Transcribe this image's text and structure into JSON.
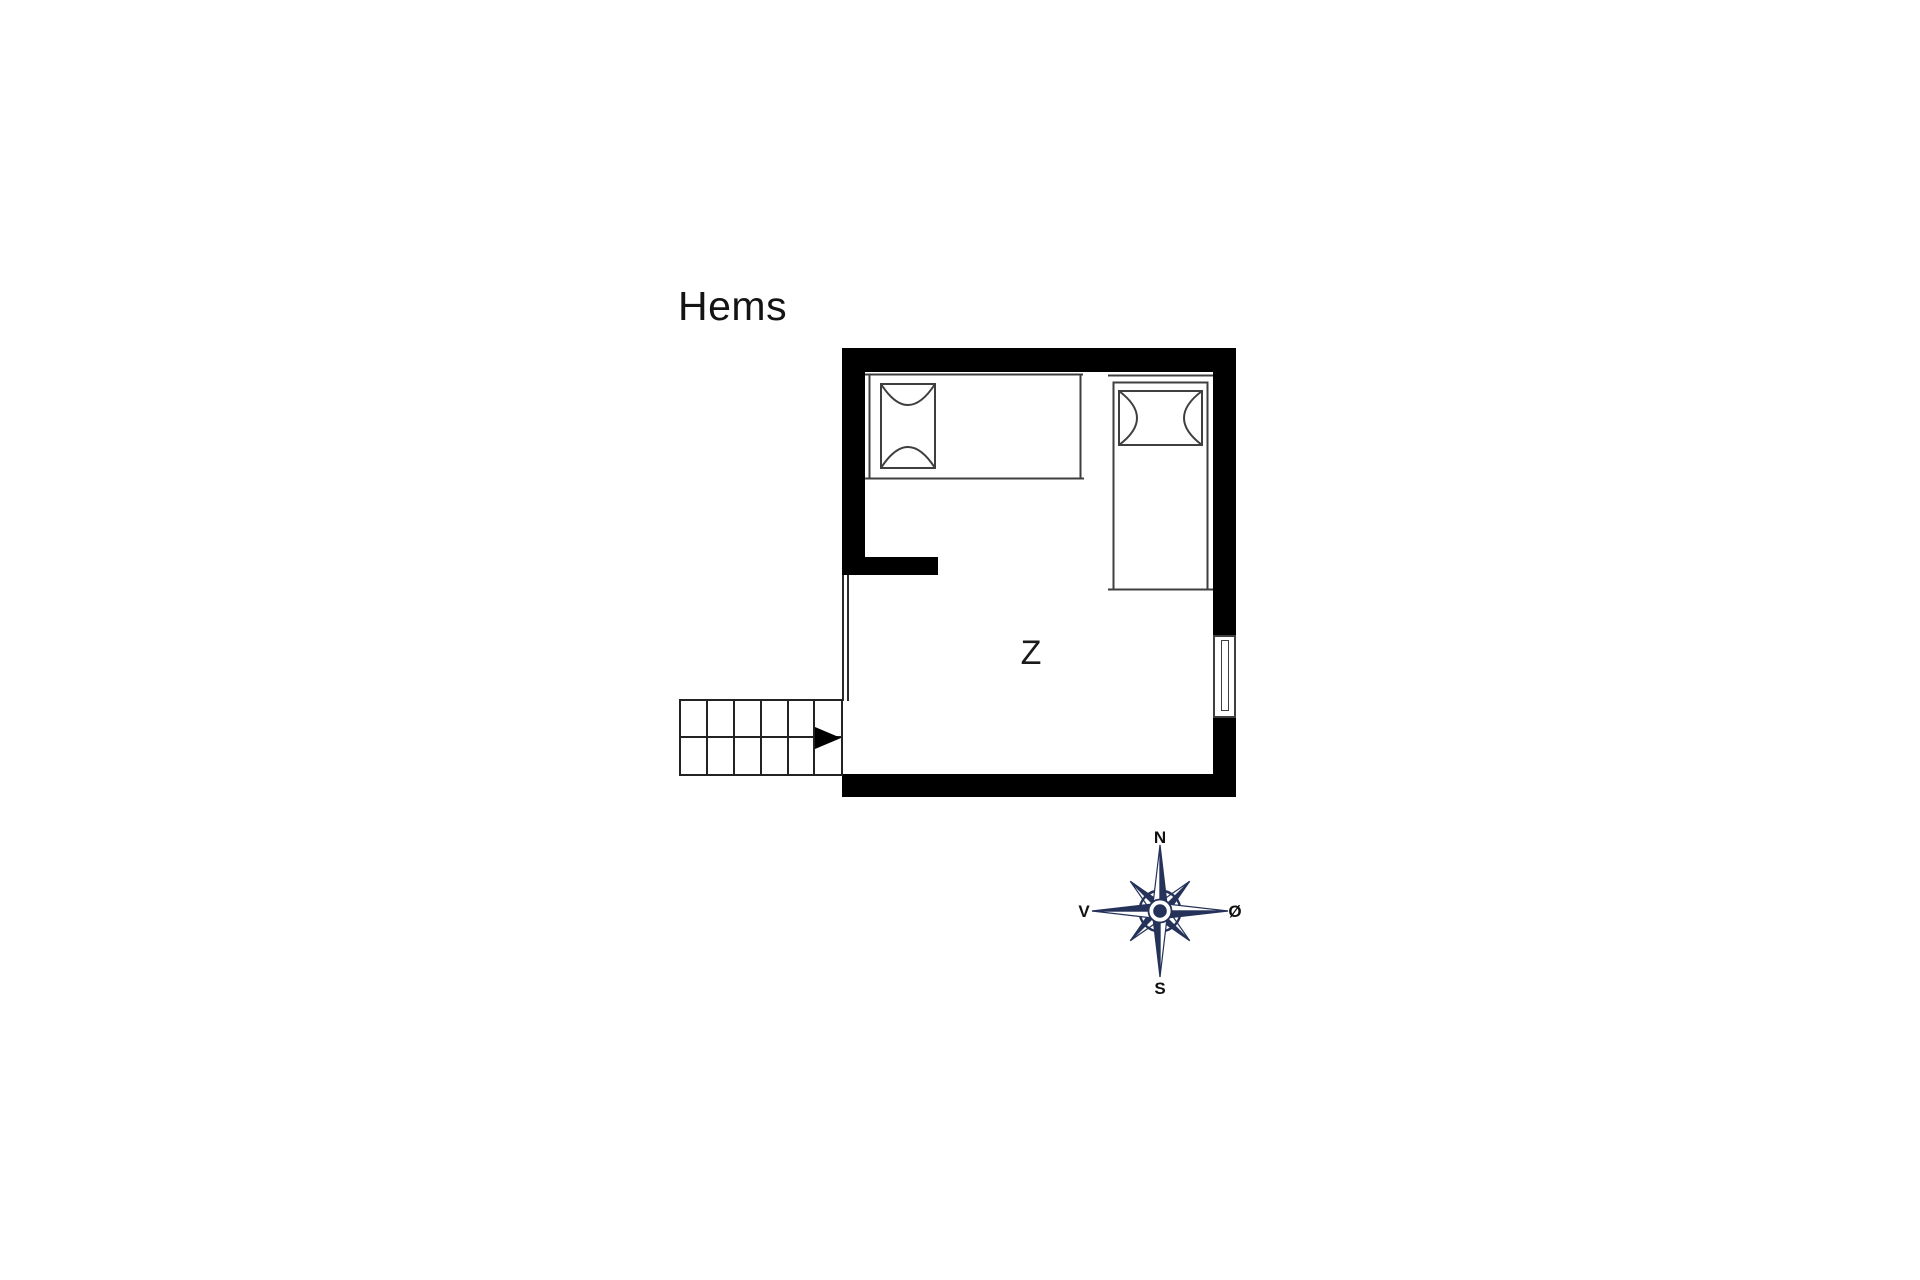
{
  "page": {
    "background_color": "#ffffff"
  },
  "floor_plan": {
    "title": "Hems",
    "room": {
      "label": "Z"
    },
    "features": {
      "bed_count": 2,
      "window_location": "right-wall",
      "stairs": {
        "step_columns": 6,
        "step_rows": 2,
        "arrow_direction": "right"
      }
    },
    "colors": {
      "wall": "#000000",
      "furniture_line": "#3f3f3f",
      "stairs_line": "#222222"
    }
  },
  "compass": {
    "color": "#25325a",
    "labels": {
      "north": "N",
      "south": "S",
      "west": "V",
      "east": "Ø"
    }
  }
}
